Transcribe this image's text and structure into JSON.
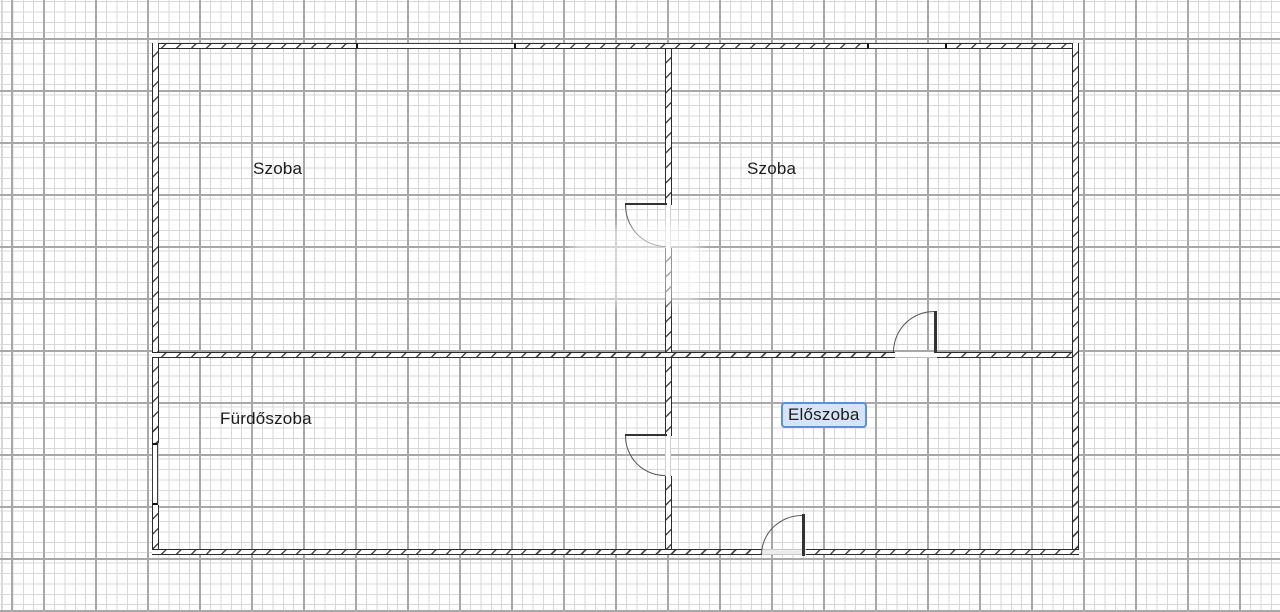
{
  "plan": {
    "type": "floor-plan",
    "rooms": [
      {
        "label": "Szoba",
        "selected": false
      },
      {
        "label": "Szoba",
        "selected": false
      },
      {
        "label": "Fürdőszoba",
        "selected": false
      },
      {
        "label": "Előszoba",
        "selected": true
      }
    ],
    "door_count": 4,
    "window_count": 3
  },
  "colors": {
    "background": "#ffffff",
    "grid_minor": "#d9d9d9",
    "grid_major": "#a8a8a8",
    "wall": "#2b2b2b",
    "selection_border": "#5e8fd8",
    "selection_fill": "#d7e4f7",
    "label_text": "#1c1c1c"
  }
}
